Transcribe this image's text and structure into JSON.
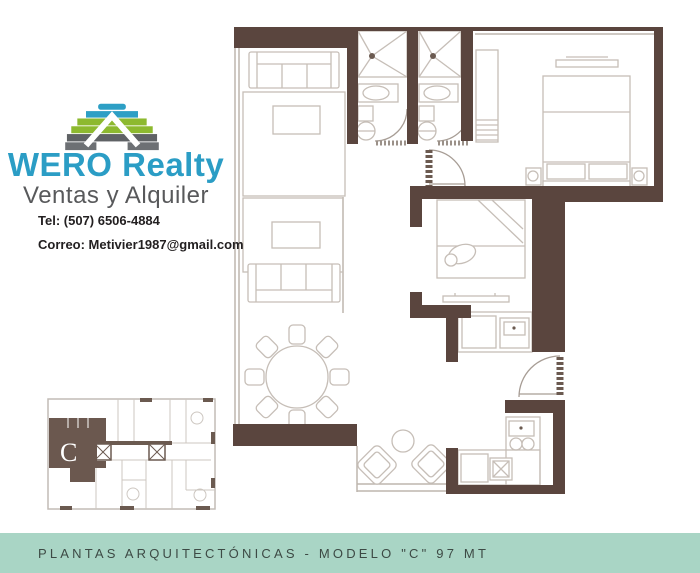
{
  "brand": {
    "name": "WERO Realty",
    "tagline": "Ventas y Alquiler",
    "phone": "Tel: (507) 6506-4884",
    "email": "Correo:  Metivier1987@gmail.com",
    "colors": {
      "brand_blue": "#2b9dc5",
      "brand_green": "#8db92f",
      "brand_gray": "#606468",
      "tagline_gray": "#58595b"
    }
  },
  "floor_plan": {
    "unit_label": "C",
    "wall_color": "#5a453e",
    "furniture_line_color": "#c6beb7",
    "fixture_accent_color": "#6b5a50"
  },
  "footer": {
    "caption": "PLANTAS ARQUITECTÓNICAS - MODELO \"C\" 97 MT",
    "bar_color": "#a9d5c5",
    "text_color": "#3d4a45"
  }
}
